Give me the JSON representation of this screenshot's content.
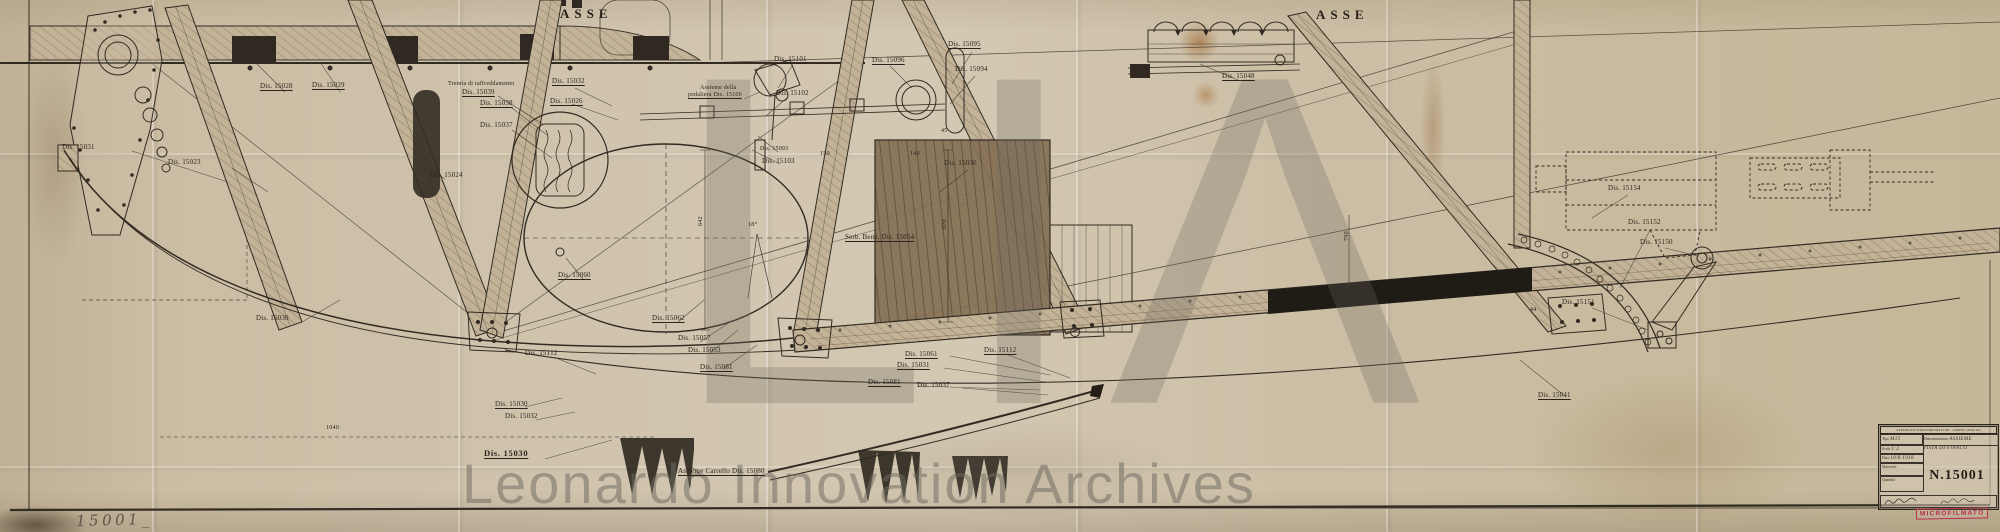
{
  "document": {
    "axis_left": "ASSE",
    "axis_right": "ASSE",
    "pencil_number": "15001_",
    "stamp": "MICROFILMATO"
  },
  "watermark": {
    "monogram": "LIΛ",
    "text": "Leonardo Innovation Archives"
  },
  "title_block": {
    "header": "AEROPLANI NIEUPORT-MACCHI - VARESE (ITALIA)",
    "tipo_label": "Tipo",
    "tipo_value": "M15",
    "denominazione_label": "Denominazione",
    "denominazione_value": "ASSIEME",
    "denominazione_value2": "VISTA DI FIANCO",
    "scala_label": "Scala",
    "scala_value": "1:2",
    "data_label": "Data",
    "data_value": "10/8 1918",
    "materiale_label": "Materiale",
    "materiale_value": "",
    "quantita_label": "Quantità",
    "quantita_value": "",
    "number": "N.15001"
  },
  "part_labels": [
    {
      "text": "Dis. 15031",
      "x": 62,
      "y": 143
    },
    {
      "text": "Dis. 15023",
      "x": 168,
      "y": 158
    },
    {
      "text": "Dis. 15028",
      "x": 260,
      "y": 82,
      "u": 1
    },
    {
      "text": "Dis. 15029",
      "x": 312,
      "y": 81,
      "u": 1
    },
    {
      "text": "Tremia di raffreddamento",
      "x": 448,
      "y": 81,
      "fs": 6
    },
    {
      "text": "Dis. 15039",
      "x": 462,
      "y": 88,
      "u": 1
    },
    {
      "text": "Dis. 15032",
      "x": 552,
      "y": 77,
      "u": 1
    },
    {
      "text": "Dis. 15026",
      "x": 550,
      "y": 97,
      "u": 1
    },
    {
      "text": "Dis. 15038",
      "x": 480,
      "y": 99,
      "u": 1
    },
    {
      "text": "Dis. 15037",
      "x": 480,
      "y": 121
    },
    {
      "text": "Dis. 15024",
      "x": 430,
      "y": 171
    },
    {
      "text": "Dis. 15101",
      "x": 774,
      "y": 55,
      "u": 1
    },
    {
      "text": "Assieme della",
      "x": 700,
      "y": 85,
      "fs": 6
    },
    {
      "text": "pedaliera Dis. 15100",
      "x": 688,
      "y": 92,
      "fs": 6,
      "u": 1
    },
    {
      "text": "Dis. 15102",
      "x": 776,
      "y": 89
    },
    {
      "text": "Dis. 15093",
      "x": 760,
      "y": 146,
      "fs": 6
    },
    {
      "text": "Dis. 15103",
      "x": 762,
      "y": 157
    },
    {
      "text": "Dis. 15096",
      "x": 872,
      "y": 56,
      "u": 1
    },
    {
      "text": "Dis. 15095",
      "x": 948,
      "y": 40,
      "u": 1
    },
    {
      "text": "Dis. 15094",
      "x": 955,
      "y": 65
    },
    {
      "text": "Dis. 15036",
      "x": 944,
      "y": 159
    },
    {
      "text": "Dis. 15048",
      "x": 1222,
      "y": 72,
      "u": 1
    },
    {
      "text": "Serb. Benz. Dis. 15054",
      "x": 845,
      "y": 233,
      "u": 1
    },
    {
      "text": "Dis. 15062",
      "x": 652,
      "y": 314,
      "u": 1
    },
    {
      "text": "Dis. 15057",
      "x": 678,
      "y": 334
    },
    {
      "text": "Dis. 15053",
      "x": 688,
      "y": 346
    },
    {
      "text": "Dis. 15081",
      "x": 700,
      "y": 363,
      "u": 1
    },
    {
      "text": "Dis. 15061",
      "x": 905,
      "y": 350,
      "u": 1
    },
    {
      "text": "Dis. 15031",
      "x": 897,
      "y": 361,
      "u": 1
    },
    {
      "text": "Dis. 15081",
      "x": 868,
      "y": 378,
      "u": 1
    },
    {
      "text": "Dis. 15037",
      "x": 917,
      "y": 381
    },
    {
      "text": "Dis. 15112",
      "x": 984,
      "y": 346,
      "u": 1
    },
    {
      "text": "Dis. 15030",
      "x": 256,
      "y": 314
    },
    {
      "text": "Dis. 15060",
      "x": 558,
      "y": 271,
      "u": 1
    },
    {
      "text": "Dis. 15112",
      "x": 525,
      "y": 349
    },
    {
      "text": "Dis. 15030",
      "x": 495,
      "y": 400,
      "u": 1
    },
    {
      "text": "Dis. 15032",
      "x": 505,
      "y": 412
    },
    {
      "text": "Dis. 15030",
      "x": 484,
      "y": 448,
      "big": 1,
      "u": 1
    },
    {
      "text": "Assieme Carrello Dis. 15080",
      "x": 678,
      "y": 467,
      "u": 1
    },
    {
      "text": "Dis. 15154",
      "x": 1608,
      "y": 184
    },
    {
      "text": "Dis. 15152",
      "x": 1628,
      "y": 218
    },
    {
      "text": "Dis. 15150",
      "x": 1640,
      "y": 238
    },
    {
      "text": "Dis. 15151",
      "x": 1562,
      "y": 298
    },
    {
      "text": "Dis. 15041",
      "x": 1538,
      "y": 391,
      "u": 1
    }
  ],
  "dimensions": [
    {
      "text": "642",
      "x": 698,
      "y": 226,
      "rot": -90
    },
    {
      "text": "870",
      "x": 942,
      "y": 229,
      "rot": -90
    },
    {
      "text": "18°",
      "x": 748,
      "y": 222
    },
    {
      "text": "150",
      "x": 820,
      "y": 151
    },
    {
      "text": "140",
      "x": 910,
      "y": 151
    },
    {
      "text": "45",
      "x": 941,
      "y": 128
    },
    {
      "text": "44",
      "x": 1530,
      "y": 307
    },
    {
      "text": "1040",
      "x": 326,
      "y": 425
    },
    {
      "text": "790",
      "x": 1344,
      "y": 241,
      "rot": -90
    }
  ],
  "colors": {
    "paper": "#cdc0a8",
    "ink": "#2e2821",
    "stamp_red": "#b5304a",
    "watermark_gray": "#6e6a60"
  }
}
